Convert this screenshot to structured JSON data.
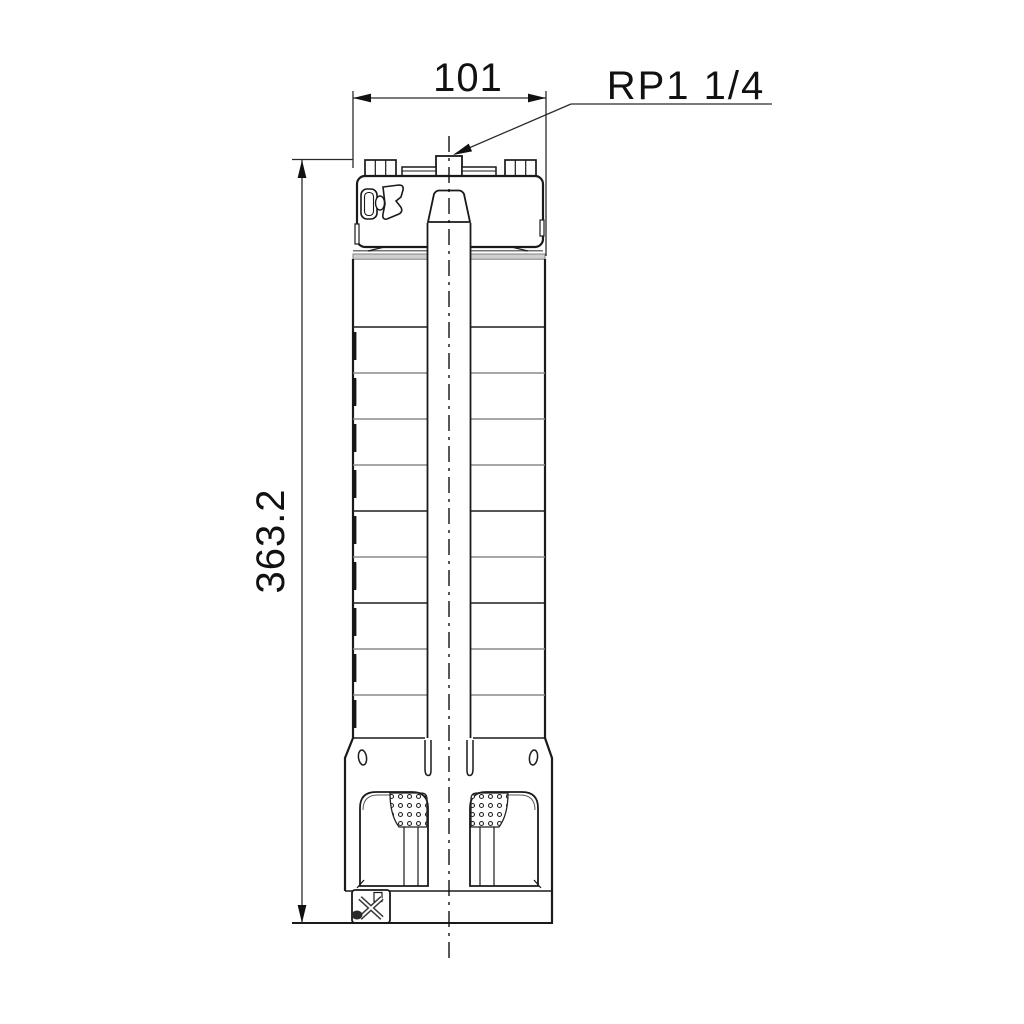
{
  "drawing": {
    "kind": "pump-dimensional-drawing",
    "dimensions": {
      "width": "101",
      "height": "363.2"
    },
    "labels": {
      "connection": "RP1 1/4"
    },
    "colors": {
      "line": "#1a1a1a",
      "dim_line": "#2b2b2b",
      "shade_band": "#cfcfcf",
      "background": "#ffffff"
    }
  }
}
